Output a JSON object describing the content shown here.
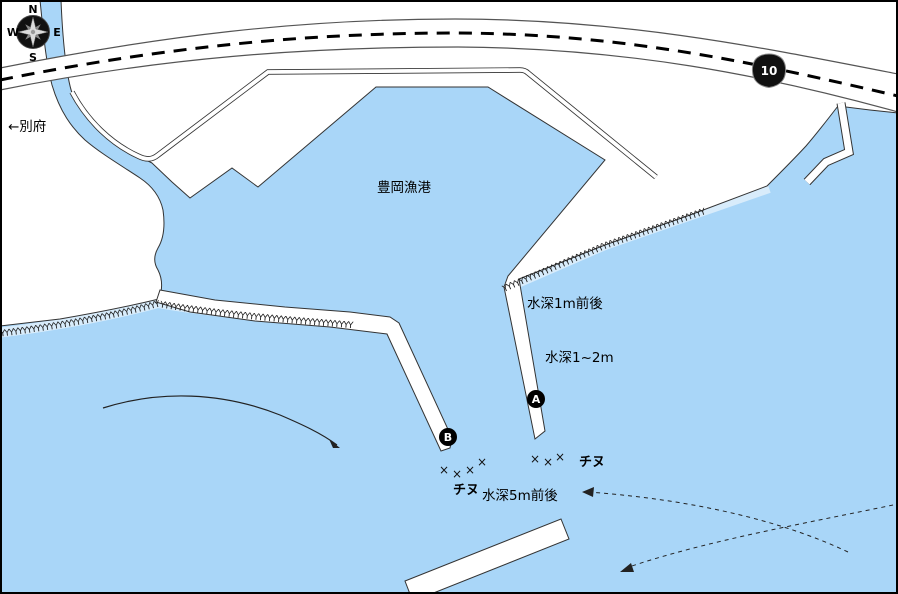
{
  "colors": {
    "water": "#A9D6F8",
    "land": "#FFFFFF",
    "line": "#333333",
    "road_edge": "#555555"
  },
  "compass": {
    "north": "N",
    "east": "E",
    "south": "S",
    "west": "W"
  },
  "road": {
    "route_number": "10"
  },
  "labels": {
    "port_name": "豊岡漁港",
    "to_beppu": "←別府",
    "depth_1m": "水深1m前後",
    "depth_1_2m": "水深1~2m",
    "depth_5m": "水深5m前後",
    "fish_left": "チヌ",
    "fish_right": "チヌ"
  },
  "markers": {
    "point_a": "A",
    "point_b": "B"
  },
  "symbols": {
    "fishing_spot": "×",
    "tetrapod_glyph": "Y"
  }
}
